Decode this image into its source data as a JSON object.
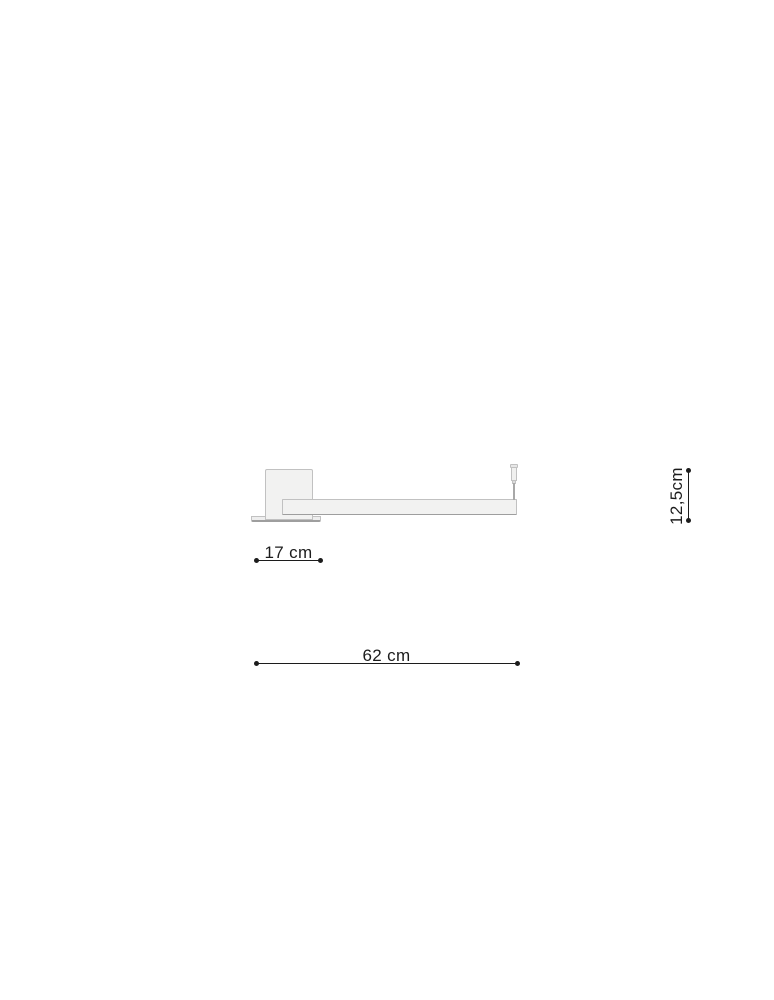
{
  "meta": {
    "type": "product dimension diagram",
    "subject": "linear lamp with rectangular canopy, side view"
  },
  "colors": {
    "page-bg": "#ffffff",
    "ink": "#1c1c1c",
    "part-fill": "#f2f2f1",
    "part-stroke": "#c1c1c1",
    "part-stroke-dark": "#9e9e9e",
    "wire": "#a8a8a8"
  },
  "dimensions": {
    "canopy_width": {
      "label": "17 cm"
    },
    "total_width": {
      "label": "62 cm"
    },
    "fixture_height": {
      "label": "12,5cm"
    }
  }
}
